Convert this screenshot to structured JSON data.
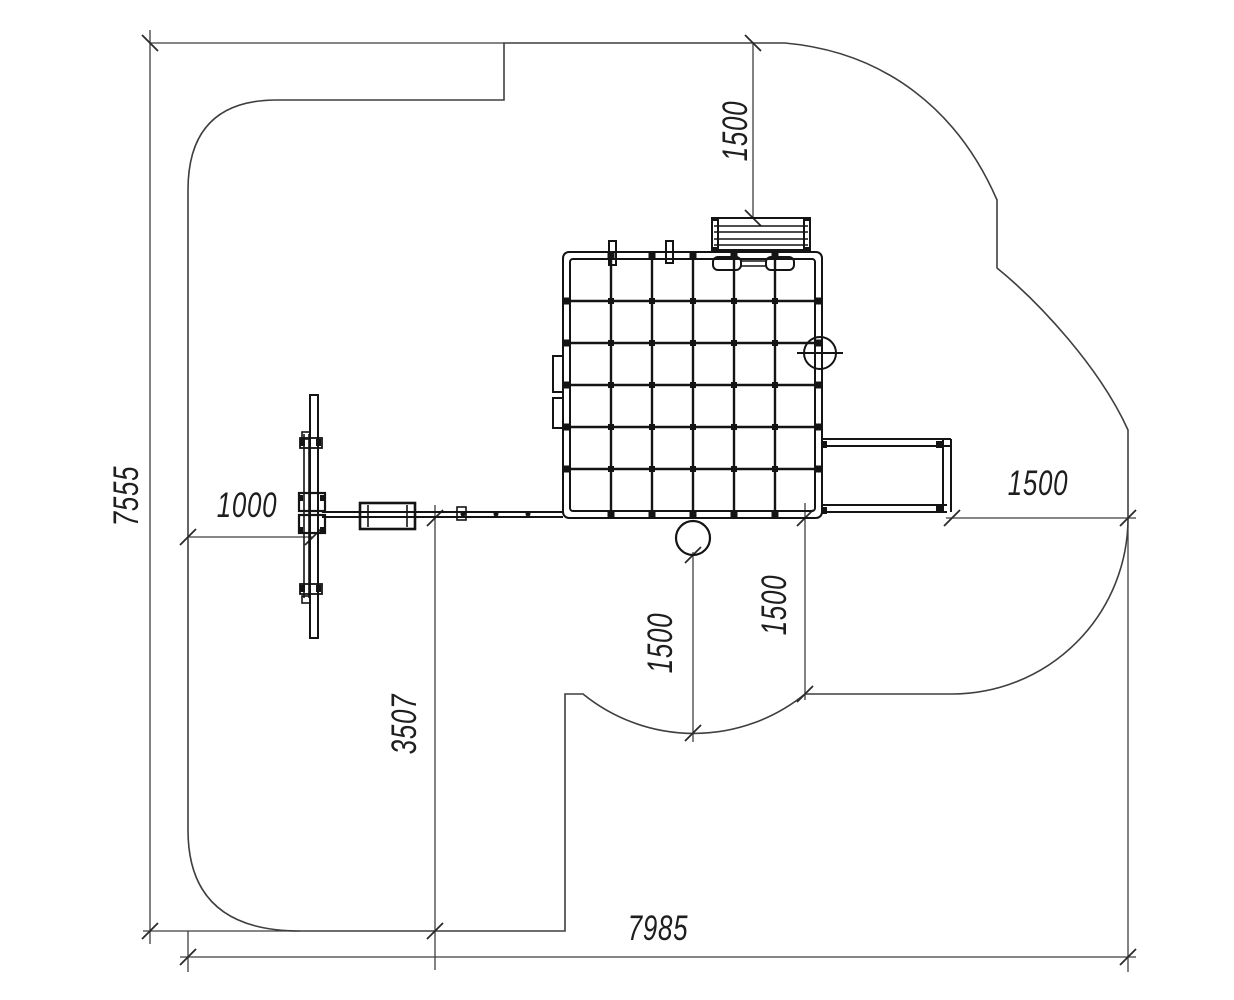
{
  "drawing": {
    "background": "#ffffff",
    "equipment_line_color": "#141414",
    "thin_line_color": "#3f3f3f",
    "dimensions": {
      "dim_left": {
        "value": "7555",
        "orientation": "vertical"
      },
      "dim_top": {
        "value": "1500",
        "orientation": "vertical"
      },
      "dim_1000": {
        "value": "1000",
        "orientation": "horizontal"
      },
      "dim_3507": {
        "value": "3507",
        "orientation": "vertical"
      },
      "dim_mid": {
        "value": "1500",
        "orientation": "vertical"
      },
      "dim_inner": {
        "value": "1500",
        "orientation": "vertical"
      },
      "dim_right": {
        "value": "1500",
        "orientation": "horizontal"
      },
      "dim_bottom": {
        "value": "7985",
        "orientation": "horizontal"
      }
    },
    "elements": {
      "boundary": "safety-zone-outline",
      "net_frame": "climbing-net-frame",
      "bench": "bench-top-view",
      "ladder": "ladder-top-view",
      "beam": "balance-beam",
      "plank": "swing-plank",
      "step": "step-platform",
      "pole": "pole-circle",
      "porthole": "porthole-circle"
    }
  }
}
